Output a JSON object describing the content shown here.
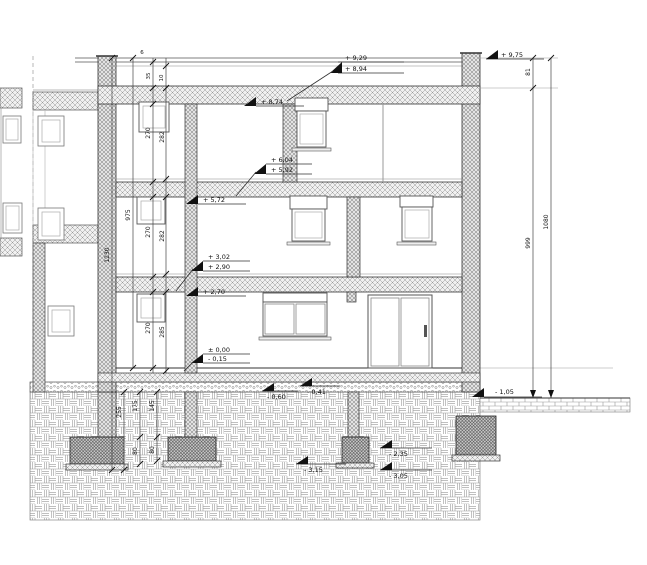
{
  "drawing": {
    "title": "building-cross-section",
    "palette": {
      "line": "#333333",
      "dim": "#444444",
      "text": "#111111",
      "background": "#ffffff"
    },
    "elevations": {
      "parapet_right": "+ 9,75",
      "roof_top": "+ 9,29",
      "roof_slab_top": "+ 8,94",
      "ceiling_2": "+ 8,74",
      "floor_2_fin": "+ 6,04",
      "floor_2_raw": "+ 5,92",
      "slab_2_top": "+ 5,72",
      "floor_1_fin": "+ 3,02",
      "floor_1_raw": "+ 2,90",
      "ceiling_0": "+ 2,70",
      "ground_floor": "± 0,00",
      "ground_raw": "- 0,15",
      "terrain_right": "- 1,05",
      "subbase_a": "- 0,60",
      "subbase_b": "- 0,41",
      "footing_top": "- 2,35",
      "footing_bottom": "- 3,05",
      "footing_base_left": "- 3,15"
    },
    "dims": {
      "total": "1230",
      "shell": "975",
      "room_top": "270",
      "room_mid": "270",
      "room_ground": "270",
      "storey_top": "282",
      "storey_mid": "282",
      "storey_ground": "285",
      "parapet": "81",
      "above_terrain": "999",
      "overall": "1080",
      "foundation_total": "255",
      "foundation_a": "175",
      "foundation_b": "145",
      "footing_h1": "80",
      "footing_h2": "80",
      "roof_t1": "6",
      "roof_t2": "35",
      "roof_t3": "10"
    }
  }
}
